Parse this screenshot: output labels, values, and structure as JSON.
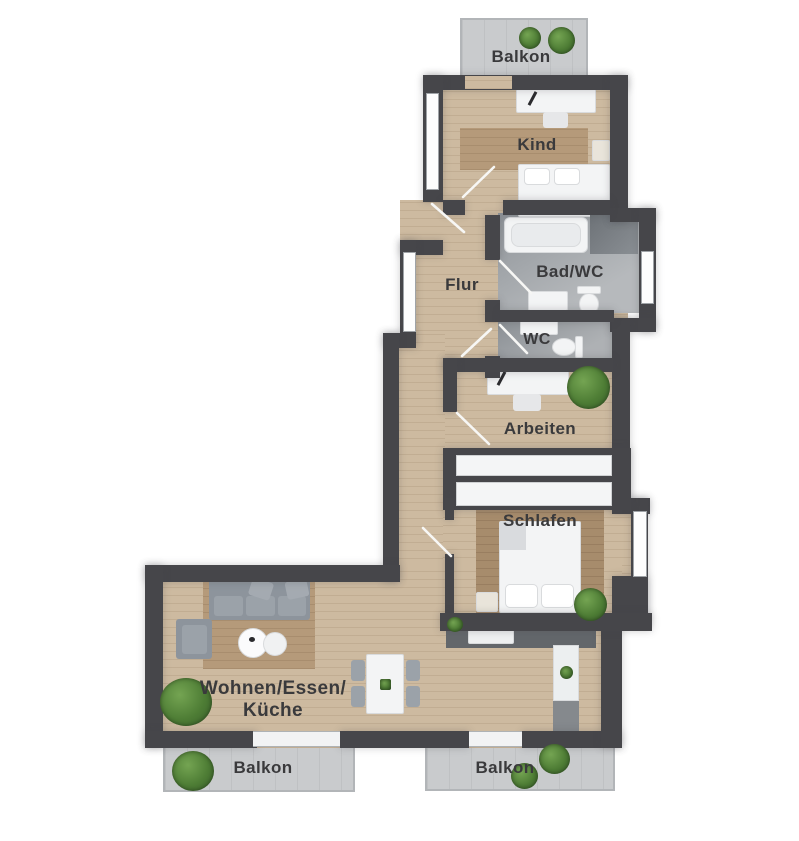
{
  "floorplan": {
    "type": "apartment-floor-plan",
    "language": "de",
    "rooms": {
      "balcony_top": {
        "label": "Balkon"
      },
      "kind": {
        "label": "Kind"
      },
      "bad_wc": {
        "label": "Bad/WC"
      },
      "flur": {
        "label": "Flur"
      },
      "wc": {
        "label": "WC"
      },
      "arbeiten": {
        "label": "Arbeiten"
      },
      "schlafen": {
        "label": "Schlafen"
      },
      "living": {
        "label_line1": "Wohnen/Essen/",
        "label_line2": "Küche"
      },
      "balcony_left": {
        "label": "Balkon"
      },
      "balcony_right": {
        "label": "Balkon"
      }
    },
    "colors": {
      "wall": "#46464a",
      "wood_floor": "#cdbaa0",
      "rug_wood": "#b59a7a",
      "bedroom_rug": "#a78c6c",
      "bath_tile": "#9aa0a5",
      "balcony_floor": "#c9cbcd",
      "label_text": "#3a3a3c",
      "plant_green": "#4e7d35",
      "furniture_white": "#f3f4f5",
      "sofa_gray": "#8d949c"
    }
  }
}
